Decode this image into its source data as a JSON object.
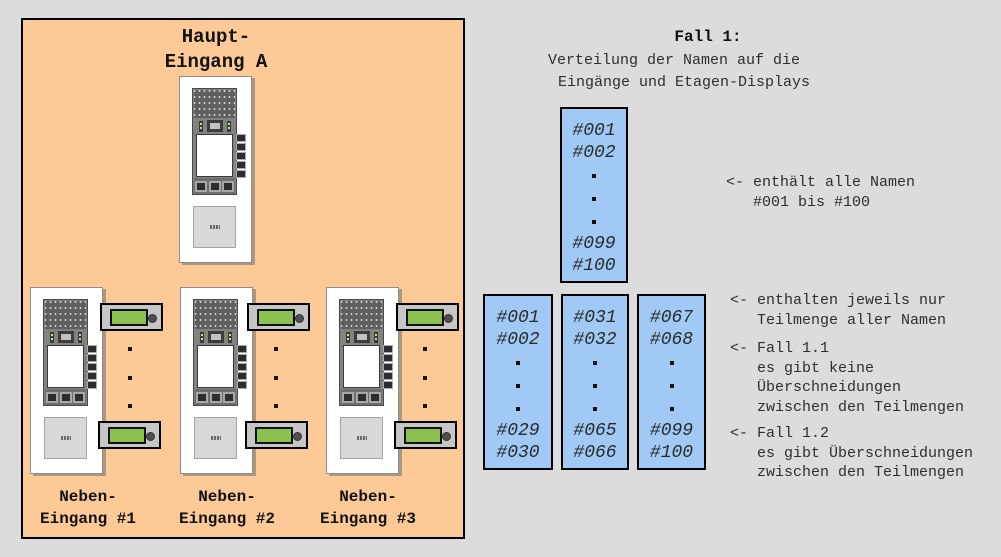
{
  "colors": {
    "background": "#dcdcdc",
    "panel_orange": "#fdc997",
    "name_box_blue": "#a0caf5",
    "lcd_green": "#8cc04f",
    "text": "#2e2e2e"
  },
  "entrance_panel": {
    "main_label": [
      "Haupt-",
      "Eingang A"
    ],
    "side_labels": [
      [
        "Neben-",
        "Eingang #1"
      ],
      [
        "Neben-",
        "Eingang #2"
      ],
      [
        "Neben-",
        "Eingang #3"
      ]
    ]
  },
  "case": {
    "title": "Fall 1:",
    "subtitle1": "Verteilung der Namen auf die",
    "subtitle2": "Eingänge und Etagen-Displays",
    "annotations": [
      {
        "text": "<- enthält alle Namen\n   #001 bis #100"
      },
      {
        "text": "<- enthalten jeweils nur\n   Teilmenge aller Namen"
      },
      {
        "text": "<- Fall 1.1\n   es gibt keine\n   Überschneidungen\n   zwischen den Teilmengen"
      },
      {
        "text": "<- Fall 1.2\n   es gibt Überschneidungen\n   zwischen den Teilmengen"
      }
    ]
  },
  "name_boxes": {
    "full": {
      "first": [
        "#001",
        "#002"
      ],
      "last": [
        "#099",
        "#100"
      ]
    },
    "subsets": [
      {
        "first": [
          "#001",
          "#002"
        ],
        "last": [
          "#029",
          "#030"
        ]
      },
      {
        "first": [
          "#031",
          "#032"
        ],
        "last": [
          "#065",
          "#066"
        ]
      },
      {
        "first": [
          "#067",
          "#068"
        ],
        "last": [
          "#099",
          "#100"
        ]
      }
    ]
  }
}
